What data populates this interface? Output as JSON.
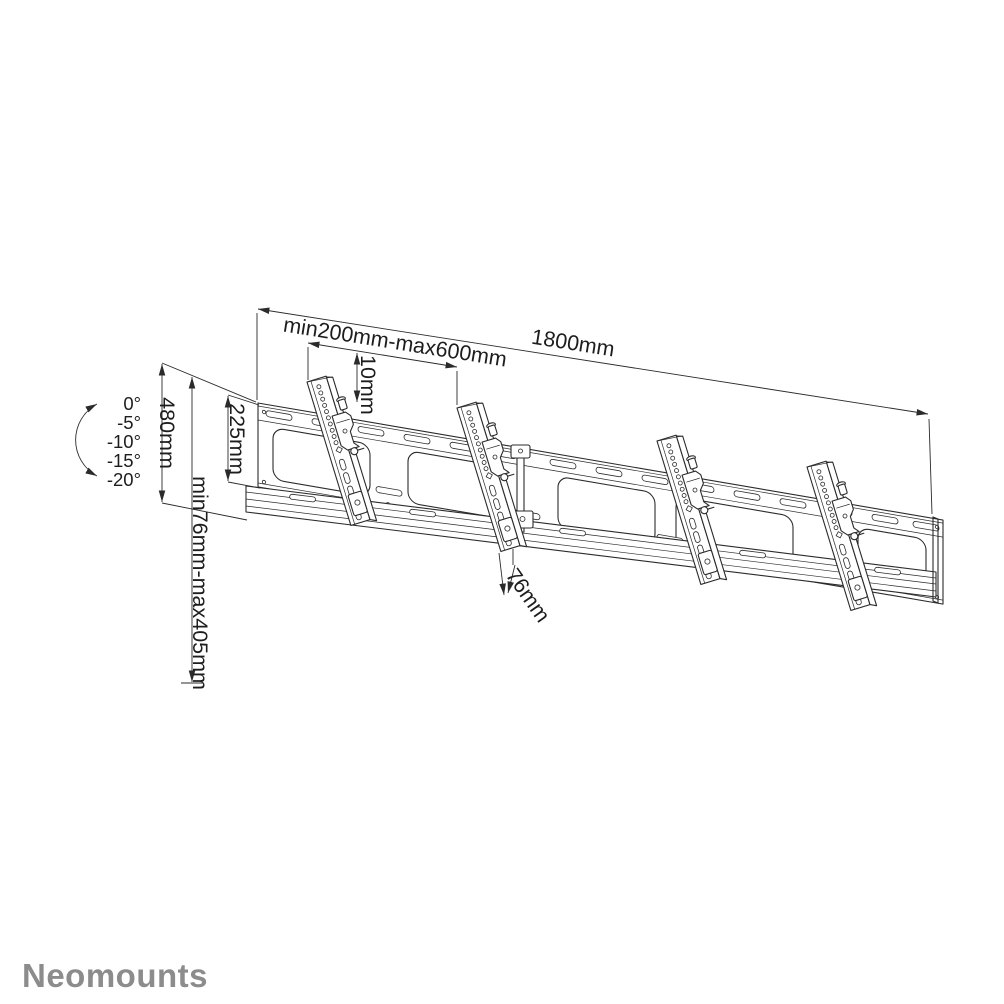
{
  "page": {
    "background": "#ffffff"
  },
  "branding": {
    "logo_text": "Neomounts",
    "logo_color": "#8c8c8c"
  },
  "diagram": {
    "type": "technical-line-drawing",
    "line_color": "#2b2b2b",
    "dimensions": {
      "rail_length": "1800mm",
      "bracket_spacing": "min200mm-max600mm",
      "top_offset": "10mm",
      "assembly_height": "480mm",
      "plate_height": "225mm",
      "vertical_range": "min76mm-max405mm",
      "bottom_depth": "76mm"
    },
    "tilt_angles": [
      "0°",
      "-5°",
      "-10°",
      "-15°",
      "-20°"
    ]
  }
}
